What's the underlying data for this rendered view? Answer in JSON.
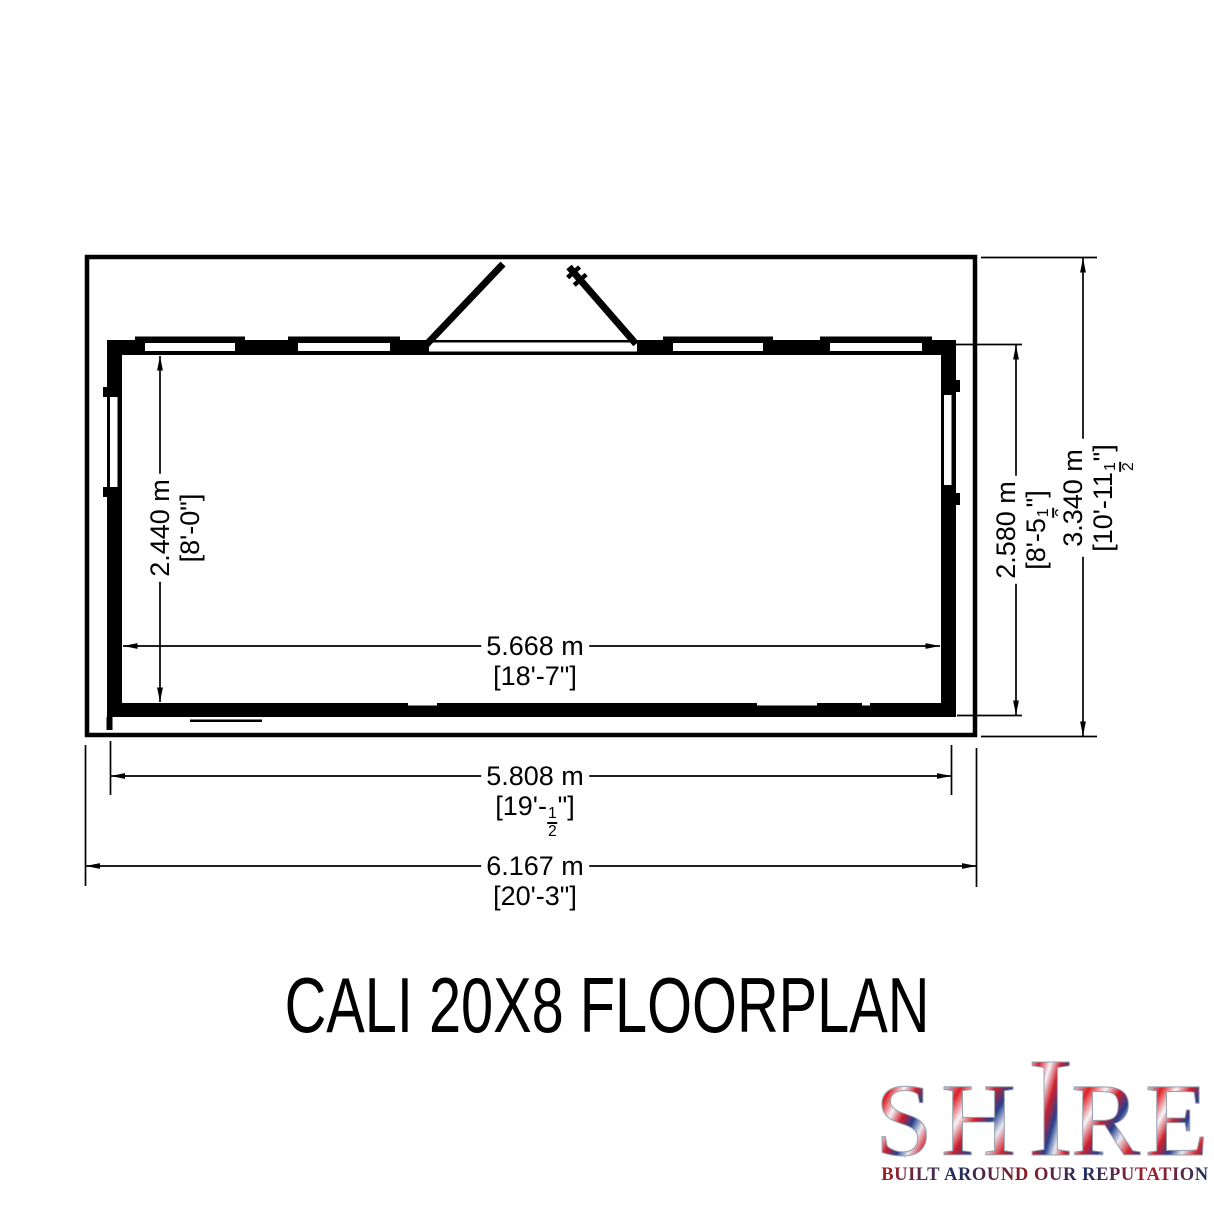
{
  "title": "CALI 20X8 FLOORPLAN",
  "logo": {
    "letters": [
      "S",
      "H",
      "I",
      "R",
      "E"
    ],
    "tagline": "BUILT AROUND OUR REPUTATION",
    "flag_colors": [
      "#27408e",
      "#c7d6ec",
      "#e01f26",
      "#f4f6fa",
      "#cf1f2c",
      "#1d3a8c"
    ],
    "tagline_colors": [
      "#a81e24",
      "#1d2f63"
    ]
  },
  "floorplan": {
    "line_color": "#000000",
    "background_color": "#ffffff",
    "dimensions": {
      "inner_width": {
        "metric": "5.668 m",
        "imperial": "[18'-7\"]"
      },
      "frame_width": {
        "metric": "5.808 m",
        "imperial": "[19'-½\"]"
      },
      "overall_width": {
        "metric": "6.167 m",
        "imperial": "[20'-3\"]"
      },
      "inner_depth": {
        "metric": "2.440 m",
        "imperial": "[8'-0\"]"
      },
      "frame_depth": {
        "metric": "2.580 m",
        "imperial": "[8'-5½\"]"
      },
      "overall_depth": {
        "metric": "3.340 m",
        "imperial": "[10'-11½\"]"
      }
    }
  }
}
